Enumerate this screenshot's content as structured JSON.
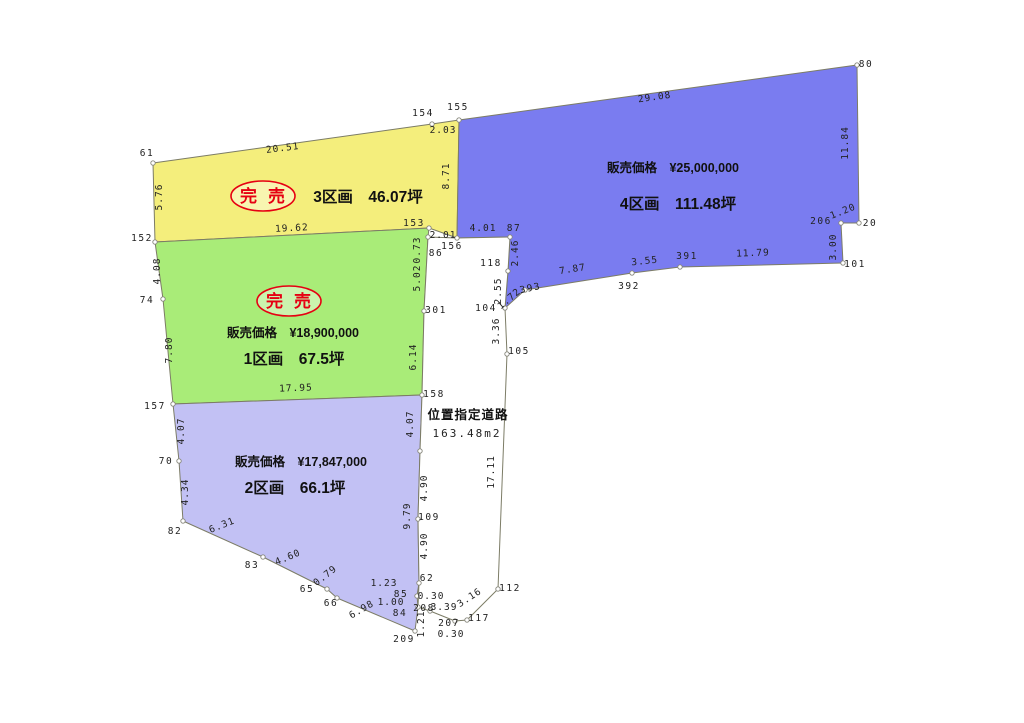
{
  "colors": {
    "background": "#ffffff",
    "line": "#7c7c66",
    "marker_stroke": "#85857a",
    "stamp_red": "#e60012",
    "lot1_green": "#a9ec78",
    "lot2_lavender": "#c2c1f4",
    "lot3_yellow": "#f4ee7c",
    "lot4_blue": "#7a7cf0",
    "road_white": "#ffffff"
  },
  "parcels": [
    {
      "id": "lot-3",
      "fill": "#f4ee7c",
      "sold_stamp": {
        "text": "完売",
        "x": 263,
        "y": 196
      },
      "title": {
        "text": "3区画　46.07坪",
        "x": 368,
        "y": 202
      },
      "polygon": [
        [
          153,
          163
        ],
        [
          432,
          124
        ],
        [
          459,
          120
        ],
        [
          457,
          238
        ],
        [
          429,
          228
        ],
        [
          155,
          242
        ]
      ]
    },
    {
      "id": "lot-4",
      "fill": "#7a7cf0",
      "price": {
        "text": "販売価格　¥25,000,000",
        "x": 673,
        "y": 172
      },
      "title": {
        "text": "4区画　111.48坪",
        "x": 678,
        "y": 209
      },
      "polygon": [
        [
          459,
          120
        ],
        [
          857,
          65
        ],
        [
          859,
          223
        ],
        [
          841,
          223
        ],
        [
          843,
          263
        ],
        [
          680,
          267
        ],
        [
          632,
          273
        ],
        [
          525,
          290
        ],
        [
          505,
          308
        ],
        [
          508,
          271
        ],
        [
          510,
          237
        ],
        [
          457,
          238
        ]
      ]
    },
    {
      "id": "lot-1",
      "fill": "#a9ec78",
      "sold_stamp": {
        "text": "完売",
        "x": 289,
        "y": 301
      },
      "price": {
        "text": "販売価格　¥18,900,000",
        "x": 293,
        "y": 337
      },
      "title": {
        "text": "1区画　67.5坪",
        "x": 294,
        "y": 364
      },
      "polygon": [
        [
          155,
          242
        ],
        [
          429,
          228
        ],
        [
          428,
          237
        ],
        [
          424,
          311
        ],
        [
          422,
          395
        ],
        [
          173,
          404
        ],
        [
          163,
          299
        ]
      ]
    },
    {
      "id": "lot-2",
      "fill": "#c2c1f4",
      "price": {
        "text": "販売価格　¥17,847,000",
        "x": 301,
        "y": 466
      },
      "title": {
        "text": "2区画　66.1坪",
        "x": 295,
        "y": 493
      },
      "polygon": [
        [
          173,
          404
        ],
        [
          422,
          395
        ],
        [
          420,
          451
        ],
        [
          418,
          519
        ],
        [
          419,
          583
        ],
        [
          417,
          596
        ],
        [
          418,
          607
        ],
        [
          415,
          631
        ],
        [
          337,
          598
        ],
        [
          327,
          589
        ],
        [
          263,
          557
        ],
        [
          183,
          521
        ],
        [
          179,
          461
        ]
      ]
    }
  ],
  "road": {
    "fill": "#ffffff",
    "name": {
      "text": "位置指定道路",
      "x": 468,
      "y": 419
    },
    "area": {
      "text": "163.48m2",
      "x": 467,
      "y": 437
    },
    "polygon": [
      [
        428,
        237
      ],
      [
        457,
        238
      ],
      [
        510,
        237
      ],
      [
        508,
        271
      ],
      [
        505,
        308
      ],
      [
        507,
        354
      ],
      [
        498,
        589
      ],
      [
        467,
        620
      ],
      [
        455,
        621
      ],
      [
        430,
        611
      ],
      [
        418,
        607
      ],
      [
        419,
        583
      ],
      [
        418,
        519
      ],
      [
        420,
        451
      ],
      [
        422,
        395
      ],
      [
        424,
        311
      ]
    ]
  },
  "measurements": [
    {
      "t": "61",
      "x": 147,
      "y": 156,
      "r": 0,
      "kind": "pt"
    },
    {
      "t": "20.51",
      "x": 283,
      "y": 151,
      "r": -7,
      "kind": "len"
    },
    {
      "t": "154",
      "x": 423,
      "y": 116,
      "r": 0,
      "kind": "pt"
    },
    {
      "t": "2.03",
      "x": 443,
      "y": 133,
      "r": 0,
      "kind": "len"
    },
    {
      "t": "155",
      "x": 458,
      "y": 110,
      "r": 0,
      "kind": "pt"
    },
    {
      "t": "5.76",
      "x": 162,
      "y": 197,
      "r": -90,
      "kind": "len"
    },
    {
      "t": "8.71",
      "x": 449,
      "y": 176,
      "r": -90,
      "kind": "len"
    },
    {
      "t": "19.62",
      "x": 292,
      "y": 231,
      "r": -3,
      "kind": "len"
    },
    {
      "t": "152",
      "x": 142,
      "y": 241,
      "r": 0,
      "kind": "pt"
    },
    {
      "t": "153",
      "x": 414,
      "y": 226,
      "r": 0,
      "kind": "pt"
    },
    {
      "t": "2.01",
      "x": 443,
      "y": 238,
      "r": 0,
      "kind": "len"
    },
    {
      "t": "0.73",
      "x": 420,
      "y": 250,
      "r": -90,
      "kind": "len"
    },
    {
      "t": "86",
      "x": 436,
      "y": 256,
      "r": 0,
      "kind": "pt"
    },
    {
      "t": "156",
      "x": 452,
      "y": 249,
      "r": 0,
      "kind": "pt"
    },
    {
      "t": "29.08",
      "x": 655,
      "y": 100,
      "r": -8,
      "kind": "len"
    },
    {
      "t": "80",
      "x": 866,
      "y": 67,
      "r": 0,
      "kind": "pt"
    },
    {
      "t": "11.84",
      "x": 848,
      "y": 143,
      "r": -90,
      "kind": "len"
    },
    {
      "t": "1.20",
      "x": 844,
      "y": 214,
      "r": -22,
      "kind": "len"
    },
    {
      "t": "206",
      "x": 821,
      "y": 224,
      "r": 0,
      "kind": "pt"
    },
    {
      "t": "20",
      "x": 870,
      "y": 226,
      "r": 0,
      "kind": "pt"
    },
    {
      "t": "3.00",
      "x": 836,
      "y": 247,
      "r": -90,
      "kind": "len"
    },
    {
      "t": "101",
      "x": 855,
      "y": 267,
      "r": 0,
      "kind": "pt"
    },
    {
      "t": "11.79",
      "x": 753,
      "y": 256,
      "r": -2,
      "kind": "len"
    },
    {
      "t": "391",
      "x": 687,
      "y": 259,
      "r": 0,
      "kind": "pt"
    },
    {
      "t": "3.55",
      "x": 645,
      "y": 264,
      "r": -6,
      "kind": "len"
    },
    {
      "t": "392",
      "x": 629,
      "y": 289,
      "r": 0,
      "kind": "pt"
    },
    {
      "t": "7.87",
      "x": 573,
      "y": 272,
      "r": -9,
      "kind": "len"
    },
    {
      "t": "393",
      "x": 531,
      "y": 291,
      "r": -12,
      "kind": "pt"
    },
    {
      "t": "1.72",
      "x": 511,
      "y": 301,
      "r": -40,
      "kind": "len"
    },
    {
      "t": "2.46",
      "x": 518,
      "y": 253,
      "r": -90,
      "kind": "len"
    },
    {
      "t": "87",
      "x": 514,
      "y": 231,
      "r": 0,
      "kind": "pt"
    },
    {
      "t": "4.01",
      "x": 483,
      "y": 231,
      "r": 0,
      "kind": "len"
    },
    {
      "t": "118",
      "x": 491,
      "y": 266,
      "r": 0,
      "kind": "pt"
    },
    {
      "t": "2.55",
      "x": 501,
      "y": 291,
      "r": -90,
      "kind": "len"
    },
    {
      "t": "104",
      "x": 486,
      "y": 311,
      "r": 0,
      "kind": "pt"
    },
    {
      "t": "3.36",
      "x": 499,
      "y": 331,
      "r": -90,
      "kind": "len"
    },
    {
      "t": "105",
      "x": 519,
      "y": 354,
      "r": 0,
      "kind": "pt"
    },
    {
      "t": "4.08",
      "x": 160,
      "y": 271,
      "r": -90,
      "kind": "len"
    },
    {
      "t": "74",
      "x": 147,
      "y": 303,
      "r": 0,
      "kind": "pt"
    },
    {
      "t": "7.80",
      "x": 172,
      "y": 350,
      "r": -90,
      "kind": "len"
    },
    {
      "t": "157",
      "x": 155,
      "y": 409,
      "r": 0,
      "kind": "pt"
    },
    {
      "t": "17.95",
      "x": 296,
      "y": 391,
      "r": -2,
      "kind": "len"
    },
    {
      "t": "158",
      "x": 434,
      "y": 397,
      "r": 0,
      "kind": "pt"
    },
    {
      "t": "6.14",
      "x": 416,
      "y": 357,
      "r": -90,
      "kind": "len"
    },
    {
      "t": "301",
      "x": 436,
      "y": 313,
      "r": 0,
      "kind": "pt"
    },
    {
      "t": "5.02",
      "x": 420,
      "y": 278,
      "r": -90,
      "kind": "len"
    },
    {
      "t": "4.07",
      "x": 184,
      "y": 431,
      "r": -90,
      "kind": "len"
    },
    {
      "t": "70",
      "x": 166,
      "y": 464,
      "r": 0,
      "kind": "pt"
    },
    {
      "t": "4.34",
      "x": 188,
      "y": 492,
      "r": -90,
      "kind": "len"
    },
    {
      "t": "82",
      "x": 175,
      "y": 534,
      "r": 0,
      "kind": "pt"
    },
    {
      "t": "6.31",
      "x": 223,
      "y": 528,
      "r": -22,
      "kind": "len"
    },
    {
      "t": "83",
      "x": 252,
      "y": 568,
      "r": 0,
      "kind": "pt"
    },
    {
      "t": "4.60",
      "x": 289,
      "y": 560,
      "r": -23,
      "kind": "len"
    },
    {
      "t": "65",
      "x": 307,
      "y": 592,
      "r": 0,
      "kind": "pt"
    },
    {
      "t": "0.79",
      "x": 327,
      "y": 578,
      "r": -38,
      "kind": "len"
    },
    {
      "t": "66",
      "x": 331,
      "y": 606,
      "r": 0,
      "kind": "pt"
    },
    {
      "t": "6.98",
      "x": 363,
      "y": 612,
      "r": -30,
      "kind": "len"
    },
    {
      "t": "209",
      "x": 404,
      "y": 642,
      "r": 0,
      "kind": "pt"
    },
    {
      "t": "1.21",
      "x": 424,
      "y": 624,
      "r": -90,
      "kind": "len"
    },
    {
      "t": "84",
      "x": 400,
      "y": 616,
      "r": 0,
      "kind": "pt"
    },
    {
      "t": "1.00",
      "x": 391,
      "y": 605,
      "r": 0,
      "kind": "len"
    },
    {
      "t": "85",
      "x": 401,
      "y": 597,
      "r": 0,
      "kind": "pt"
    },
    {
      "t": "0.30",
      "x": 431,
      "y": 599,
      "r": 0,
      "kind": "len"
    },
    {
      "t": "1.23",
      "x": 384,
      "y": 586,
      "r": 0,
      "kind": "len"
    },
    {
      "t": "62",
      "x": 427,
      "y": 581,
      "r": 0,
      "kind": "pt"
    },
    {
      "t": "4.90",
      "x": 427,
      "y": 546,
      "r": -90,
      "kind": "len"
    },
    {
      "t": "109",
      "x": 429,
      "y": 520,
      "r": 0,
      "kind": "pt"
    },
    {
      "t": "9.79",
      "x": 410,
      "y": 516,
      "r": -90,
      "kind": "len"
    },
    {
      "t": "4.90",
      "x": 427,
      "y": 488,
      "r": -90,
      "kind": "len"
    },
    {
      "t": "4.07",
      "x": 413,
      "y": 424,
      "r": -90,
      "kind": "len"
    },
    {
      "t": "17.11",
      "x": 494,
      "y": 472,
      "r": -90,
      "kind": "len"
    },
    {
      "t": "112",
      "x": 510,
      "y": 591,
      "r": 0,
      "kind": "pt"
    },
    {
      "t": "3.16",
      "x": 471,
      "y": 600,
      "r": -33,
      "kind": "len"
    },
    {
      "t": "117",
      "x": 479,
      "y": 621,
      "r": 0,
      "kind": "pt"
    },
    {
      "t": "207",
      "x": 449,
      "y": 626,
      "r": 0,
      "kind": "pt"
    },
    {
      "t": "0.30",
      "x": 451,
      "y": 637,
      "r": 0,
      "kind": "len"
    },
    {
      "t": "3.39",
      "x": 444,
      "y": 610,
      "r": 0,
      "kind": "len"
    },
    {
      "t": "208",
      "x": 424,
      "y": 611,
      "r": 0,
      "kind": "pt"
    }
  ],
  "markers": [
    [
      153,
      163
    ],
    [
      432,
      124
    ],
    [
      459,
      120
    ],
    [
      429,
      228
    ],
    [
      155,
      242
    ],
    [
      457,
      238
    ],
    [
      428,
      237
    ],
    [
      163,
      299
    ],
    [
      173,
      404
    ],
    [
      424,
      311
    ],
    [
      422,
      395
    ],
    [
      179,
      461
    ],
    [
      183,
      521
    ],
    [
      263,
      557
    ],
    [
      327,
      589
    ],
    [
      337,
      598
    ],
    [
      415,
      631
    ],
    [
      418,
      607
    ],
    [
      417,
      596
    ],
    [
      419,
      583
    ],
    [
      418,
      519
    ],
    [
      420,
      451
    ],
    [
      510,
      237
    ],
    [
      508,
      271
    ],
    [
      505,
      308
    ],
    [
      507,
      354
    ],
    [
      498,
      589
    ],
    [
      467,
      620
    ],
    [
      455,
      621
    ],
    [
      430,
      611
    ],
    [
      525,
      290
    ],
    [
      632,
      273
    ],
    [
      680,
      267
    ],
    [
      843,
      263
    ],
    [
      841,
      223
    ],
    [
      859,
      223
    ],
    [
      857,
      65
    ]
  ]
}
